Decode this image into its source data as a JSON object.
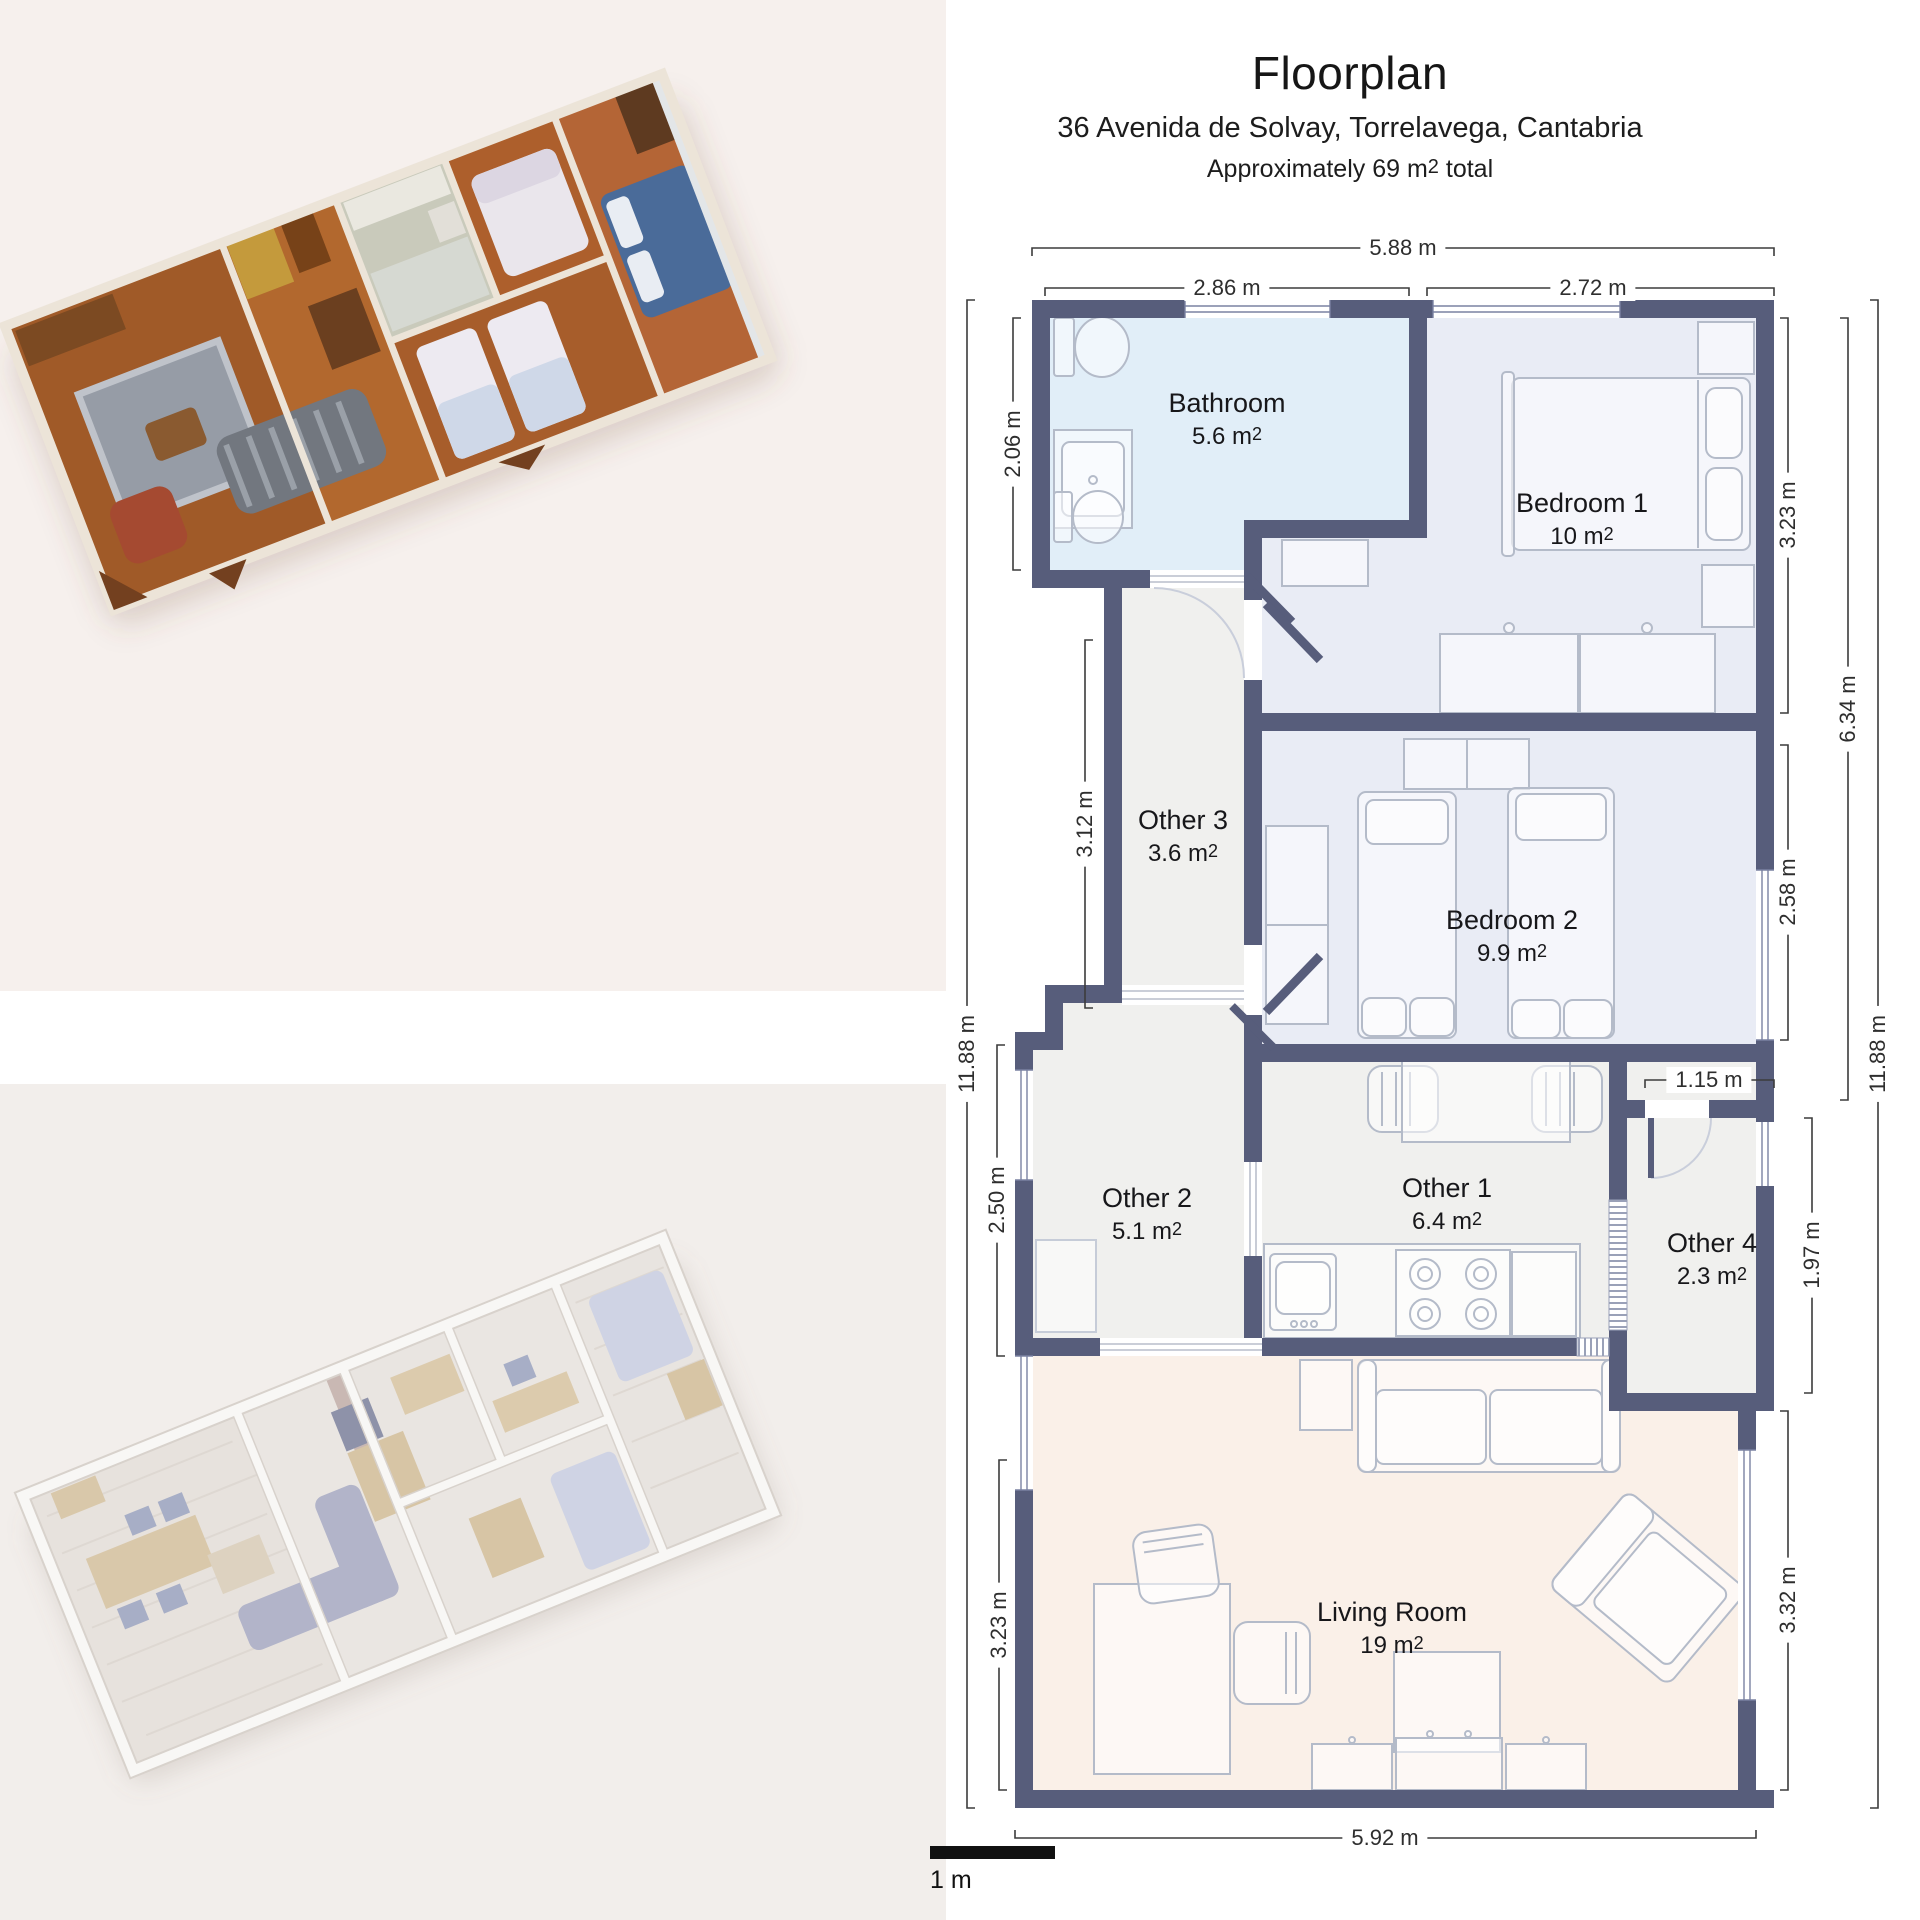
{
  "views": {
    "dollhouse_3d": {
      "name": "textured 3D dollhouse scan view",
      "background": "#f6f0ed"
    },
    "model_3d": {
      "name": "white 3D model view",
      "background": "#f2eeeb"
    }
  },
  "header": {
    "title": "Floorplan",
    "address": "36 Avenida de Solvay, Torrelavega, Cantabria",
    "total_prefix": "Approximately 69 m",
    "total_sup": "2",
    "total_suffix": " total"
  },
  "floorplan": {
    "colors": {
      "wall": "#575d7b",
      "bathroom_floor": "#e1eef8",
      "bedroom_floor": "#e9ecf5",
      "neutral_floor": "#f0f0ee",
      "living_floor": "#faf0e8",
      "furniture_line": "#b4bbc9",
      "dimension_line": "#3c3c3c"
    },
    "area_unit": "m",
    "area_sup": "2",
    "rooms": [
      {
        "name": "Bathroom",
        "area": "5.6"
      },
      {
        "name": "Bedroom 1",
        "area": "10"
      },
      {
        "name": "Other 3",
        "area": "3.6"
      },
      {
        "name": "Bedroom 2",
        "area": "9.9"
      },
      {
        "name": "Other 2",
        "area": "5.1"
      },
      {
        "name": "Other 1",
        "area": "6.4"
      },
      {
        "name": "Other 4",
        "area": "2.3"
      },
      {
        "name": "Living Room",
        "area": "19"
      }
    ],
    "dimensions": {
      "top_total": "5.88 m",
      "top_left": "2.86 m",
      "top_right": "2.72 m",
      "left_total": "11.88 m",
      "left_bathroom": "2.06 m",
      "left_other3": "3.12 m",
      "left_other2": "2.50 m",
      "left_living": "3.23 m",
      "right_bedroom1": "3.23 m",
      "right_mid": "6.34 m",
      "right_bedroom2": "2.58 m",
      "right_other4": "1.97 m",
      "right_living": "3.32 m",
      "right_total": "11.88 m",
      "nook_width": "1.15 m",
      "bottom_total": "5.92 m"
    },
    "scale_label": "1 m"
  }
}
